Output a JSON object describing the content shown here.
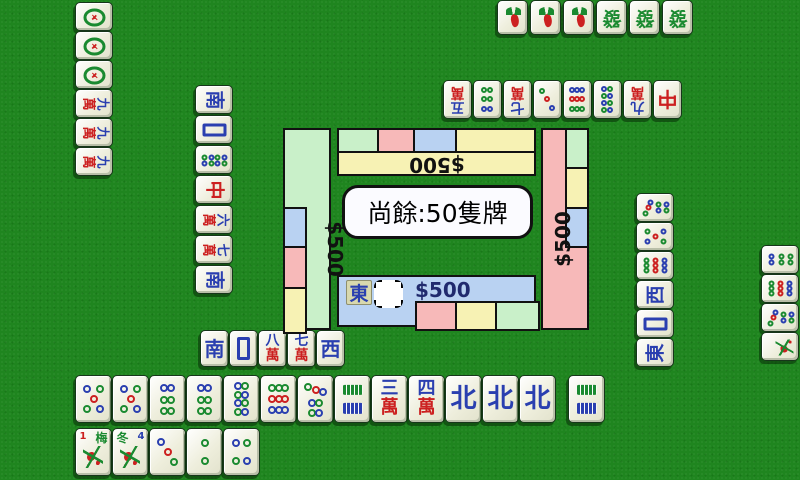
{
  "theme": {
    "felt": "#1f851f",
    "face": "#eeeedc",
    "wallGreen": "#c9f0c9",
    "wallPink": "#f7b9b9",
    "wallBlue": "#b9d2f2",
    "wallYellow": "#f7f2b4",
    "charBlue": "#2a3fb0",
    "charRed": "#cc2020",
    "charGreen": "#1a8a30",
    "moneyDark": "#202a6e"
  },
  "center": {
    "bubble_text": "尚餘:50隻牌",
    "remaining_tiles": 50,
    "money_top": "$500",
    "money_left": "$500",
    "money_right": "$500",
    "money_bottom": "$500",
    "dealer_wind": "東",
    "walls": {
      "top": {
        "base": "yellow",
        "outer_segments": [
          "green",
          "pink",
          "blue",
          "yellow"
        ],
        "money_rotation": 180
      },
      "left": {
        "base": "green",
        "inner_segments": [
          "blue",
          "pink",
          "yellow"
        ],
        "money_rotation": 90
      },
      "right": {
        "base": "pink",
        "outer_segments": [
          "green",
          "yellow",
          "blue",
          "pink"
        ],
        "money_rotation": -90
      },
      "bottom": {
        "base": "blue",
        "inner_segments": [
          "blue",
          "pink",
          "yellow",
          "green"
        ],
        "money_rotation": 0
      }
    }
  },
  "dot_patterns": {
    "2": [
      [
        50,
        30,
        "g"
      ],
      [
        50,
        72,
        "g"
      ]
    ],
    "3": [
      [
        30,
        26,
        "b"
      ],
      [
        50,
        50,
        "r"
      ],
      [
        70,
        74,
        "g"
      ]
    ],
    "4": [
      [
        34,
        30,
        "b"
      ],
      [
        66,
        30,
        "g"
      ],
      [
        34,
        70,
        "g"
      ],
      [
        66,
        70,
        "b"
      ]
    ],
    "5": [
      [
        30,
        26,
        "b"
      ],
      [
        70,
        26,
        "g"
      ],
      [
        50,
        50,
        "r"
      ],
      [
        30,
        74,
        "g"
      ],
      [
        70,
        74,
        "b"
      ]
    ],
    "6": [
      [
        38,
        24,
        "b"
      ],
      [
        62,
        24,
        "b"
      ],
      [
        38,
        52,
        "g"
      ],
      [
        62,
        52,
        "g"
      ],
      [
        38,
        78,
        "g"
      ],
      [
        62,
        78,
        "g"
      ]
    ],
    "7": [
      [
        28,
        22,
        "g"
      ],
      [
        50,
        28,
        "r"
      ],
      [
        72,
        34,
        "b"
      ],
      [
        38,
        60,
        "b"
      ],
      [
        62,
        60,
        "g"
      ],
      [
        38,
        82,
        "g"
      ],
      [
        62,
        82,
        "b"
      ]
    ],
    "8": [
      [
        38,
        20,
        "b"
      ],
      [
        62,
        20,
        "g"
      ],
      [
        38,
        40,
        "g"
      ],
      [
        62,
        40,
        "b"
      ],
      [
        38,
        60,
        "b"
      ],
      [
        62,
        60,
        "g"
      ],
      [
        38,
        80,
        "g"
      ],
      [
        62,
        80,
        "b"
      ]
    ],
    "9": [
      [
        30,
        24,
        "g"
      ],
      [
        50,
        24,
        "g"
      ],
      [
        70,
        24,
        "g"
      ],
      [
        30,
        50,
        "r"
      ],
      [
        50,
        50,
        "r"
      ],
      [
        70,
        50,
        "r"
      ],
      [
        30,
        76,
        "b"
      ],
      [
        50,
        76,
        "b"
      ],
      [
        70,
        76,
        "b"
      ]
    ]
  },
  "players": {
    "left": {
      "melds": [
        {
          "label": "一筒",
          "face": {
            "t": "dot1"
          }
        },
        {
          "label": "一筒",
          "face": {
            "t": "dot1"
          }
        },
        {
          "label": "一筒",
          "face": {
            "t": "dot1"
          }
        },
        {
          "label": "九萬",
          "face": {
            "t": "c2",
            "top": "九"
          }
        },
        {
          "label": "九萬",
          "face": {
            "t": "c2",
            "top": "九"
          }
        },
        {
          "label": "九萬",
          "face": {
            "t": "c2",
            "top": "九"
          }
        }
      ],
      "discards": [
        {
          "label": "南",
          "face": {
            "t": "c1",
            "ch": "南",
            "c": "b"
          }
        },
        {
          "label": "白",
          "face": {
            "t": "white"
          }
        },
        {
          "label": "八筒",
          "face": {
            "t": "dots",
            "n": "8"
          }
        },
        {
          "label": "中",
          "face": {
            "t": "c1",
            "ch": "中",
            "c": "r"
          }
        },
        {
          "label": "六萬",
          "face": {
            "t": "c2",
            "top": "六"
          }
        },
        {
          "label": "七萬",
          "face": {
            "t": "c2",
            "top": "七"
          }
        },
        {
          "label": "南",
          "face": {
            "t": "c1",
            "ch": "南",
            "c": "b"
          }
        }
      ]
    },
    "top": {
      "melds": [
        {
          "label": "一索",
          "face": {
            "t": "bird"
          }
        },
        {
          "label": "一索",
          "face": {
            "t": "bird"
          }
        },
        {
          "label": "一索",
          "face": {
            "t": "bird"
          }
        },
        {
          "label": "發",
          "face": {
            "t": "c1",
            "ch": "發",
            "c": "g"
          }
        },
        {
          "label": "發",
          "face": {
            "t": "c1",
            "ch": "發",
            "c": "g"
          }
        },
        {
          "label": "發",
          "face": {
            "t": "c1",
            "ch": "發",
            "c": "g"
          }
        }
      ],
      "discards": [
        {
          "label": "五萬",
          "face": {
            "t": "c2",
            "top": "五"
          }
        },
        {
          "label": "六筒",
          "face": {
            "t": "dots",
            "n": "6"
          }
        },
        {
          "label": "七萬",
          "face": {
            "t": "c2",
            "top": "七"
          }
        },
        {
          "label": "三筒",
          "face": {
            "t": "dots",
            "n": "3"
          }
        },
        {
          "label": "九筒",
          "face": {
            "t": "dots",
            "n": "9"
          }
        },
        {
          "label": "八筒",
          "face": {
            "t": "dots",
            "n": "8"
          }
        },
        {
          "label": "九萬",
          "face": {
            "t": "c2",
            "top": "九"
          }
        },
        {
          "label": "中",
          "face": {
            "t": "c1",
            "ch": "中",
            "c": "r"
          }
        }
      ]
    },
    "right": {
      "discards": [
        {
          "label": "七筒",
          "face": {
            "t": "dots",
            "n": "7"
          }
        },
        {
          "label": "五筒",
          "face": {
            "t": "dots",
            "n": "5"
          }
        },
        {
          "label": "九筒",
          "face": {
            "t": "dots",
            "n": "9"
          }
        },
        {
          "label": "西",
          "face": {
            "t": "c1",
            "ch": "西",
            "c": "b"
          }
        },
        {
          "label": "白",
          "face": {
            "t": "white"
          }
        },
        {
          "label": "東",
          "face": {
            "t": "c1",
            "ch": "東",
            "c": "b"
          }
        }
      ],
      "melds": [
        {
          "label": "六筒",
          "face": {
            "t": "dots",
            "n": "6"
          }
        },
        {
          "label": "九筒",
          "face": {
            "t": "dots",
            "n": "9"
          }
        },
        {
          "label": "七筒",
          "face": {
            "t": "dots",
            "n": "7"
          }
        },
        {
          "label": "花",
          "face": {
            "t": "flower",
            "ch": "",
            "num": ""
          }
        }
      ]
    },
    "bottom": {
      "discards": [
        {
          "label": "南",
          "face": {
            "t": "c1",
            "ch": "南",
            "c": "b"
          }
        },
        {
          "label": "白",
          "face": {
            "t": "white"
          }
        },
        {
          "label": "八萬",
          "face": {
            "t": "c2",
            "top": "八"
          }
        },
        {
          "label": "七萬",
          "face": {
            "t": "c2",
            "top": "七"
          }
        },
        {
          "label": "西",
          "face": {
            "t": "c1",
            "ch": "西",
            "c": "b"
          }
        }
      ],
      "hand": [
        {
          "label": "五筒",
          "face": {
            "t": "dots",
            "n": "5"
          }
        },
        {
          "label": "五筒",
          "face": {
            "t": "dots",
            "n": "5"
          }
        },
        {
          "label": "六筒",
          "face": {
            "t": "dots",
            "n": "6"
          }
        },
        {
          "label": "六筒",
          "face": {
            "t": "dots",
            "n": "6"
          }
        },
        {
          "label": "八筒",
          "face": {
            "t": "dots",
            "n": "8"
          }
        },
        {
          "label": "九筒",
          "face": {
            "t": "dots",
            "n": "9"
          }
        },
        {
          "label": "七筒",
          "face": {
            "t": "dots",
            "n": "7"
          }
        },
        {
          "label": "二索",
          "face": {
            "t": "bam",
            "d": [
              [
                50,
                28,
                "g"
              ],
              [
                50,
                72,
                "b"
              ]
            ]
          }
        },
        {
          "label": "三萬",
          "face": {
            "t": "c2",
            "top": "三"
          }
        },
        {
          "label": "四萬",
          "face": {
            "t": "c2",
            "top": "四"
          }
        },
        {
          "label": "北",
          "face": {
            "t": "c1",
            "ch": "北",
            "c": "b"
          }
        },
        {
          "label": "北",
          "face": {
            "t": "c1",
            "ch": "北",
            "c": "b"
          }
        },
        {
          "label": "北",
          "face": {
            "t": "c1",
            "ch": "北",
            "c": "b"
          }
        }
      ],
      "drawn": [
        {
          "label": "二索",
          "face": {
            "t": "bam",
            "d": [
              [
                50,
                28,
                "g"
              ],
              [
                50,
                72,
                "b"
              ]
            ]
          }
        }
      ],
      "flowers_melds": [
        {
          "label": "梅",
          "face": {
            "t": "flower",
            "ch": "梅",
            "chc": "g",
            "num": "1",
            "numc": "r",
            "numpos": "left"
          }
        },
        {
          "label": "冬",
          "face": {
            "t": "flower",
            "ch": "冬",
            "chc": "g",
            "num": "4",
            "numc": "b",
            "numpos": "right"
          }
        },
        {
          "label": "三筒",
          "face": {
            "t": "dots",
            "n": "3"
          }
        },
        {
          "label": "二筒",
          "face": {
            "t": "dots",
            "n": "2"
          }
        },
        {
          "label": "四筒",
          "face": {
            "t": "dots",
            "n": "4"
          }
        }
      ]
    }
  }
}
